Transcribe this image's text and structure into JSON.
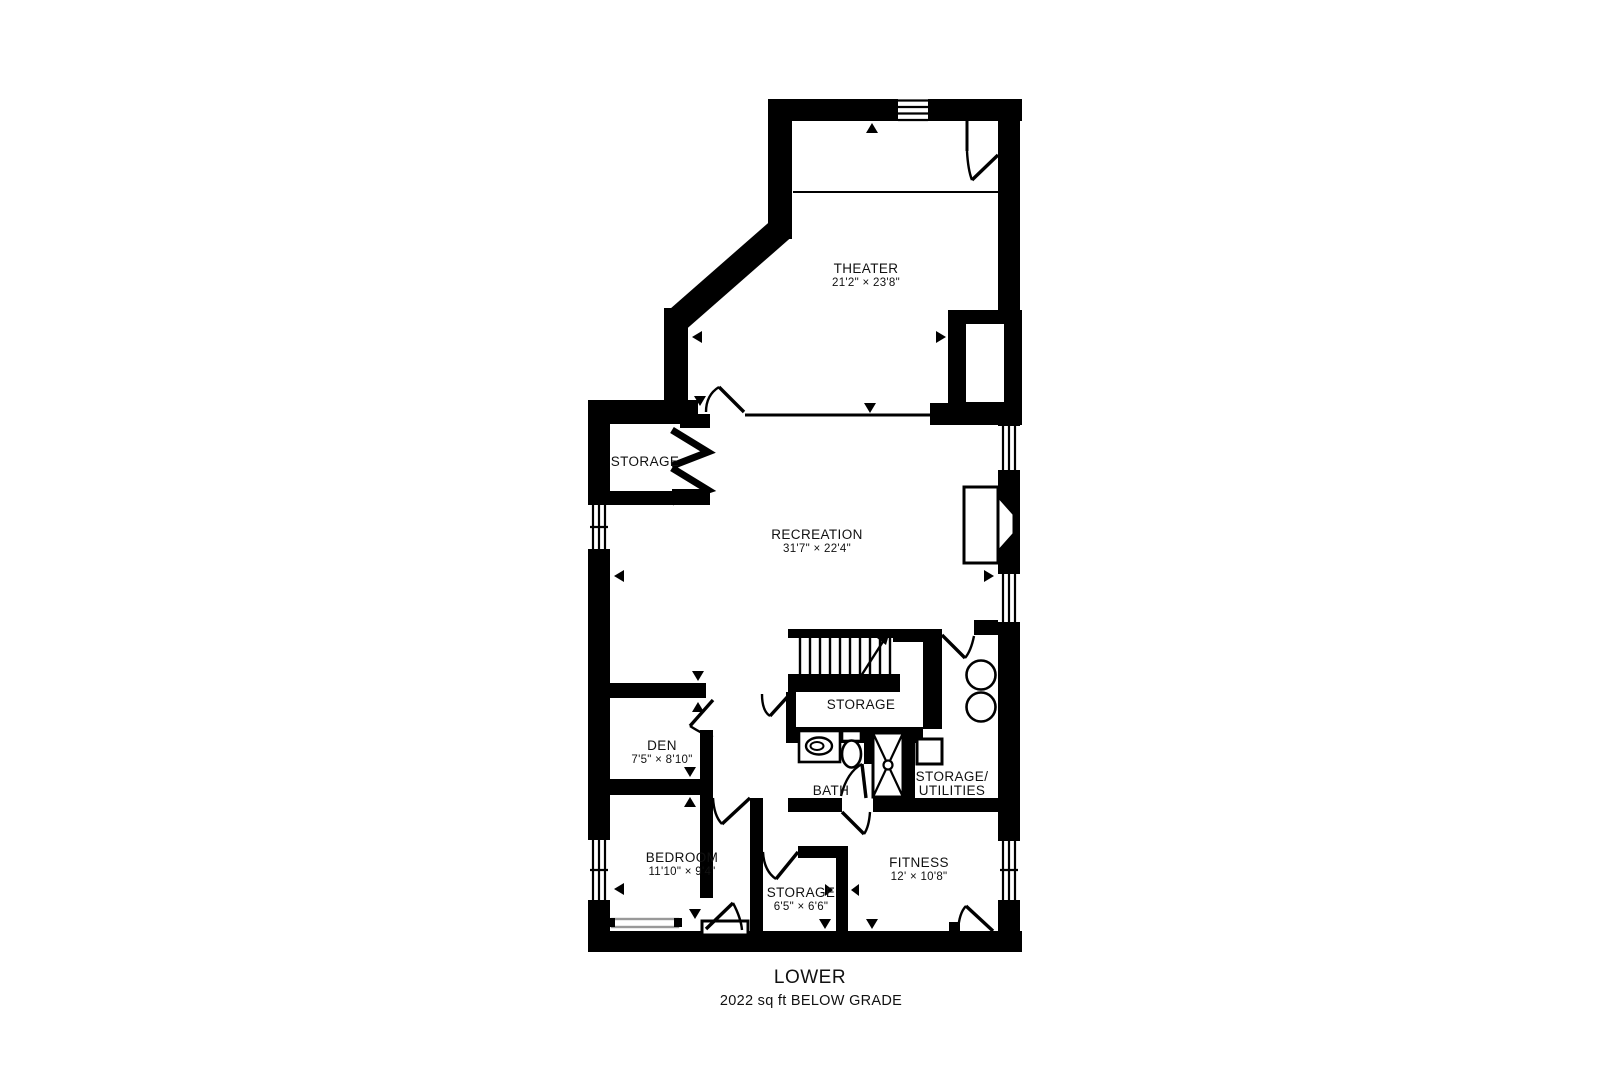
{
  "plan": {
    "title": "LOWER",
    "subtitle": "2022 sq ft BELOW GRADE",
    "colors": {
      "wall": "#000000",
      "background": "#ffffff",
      "shelf": "#999999"
    },
    "rooms": [
      {
        "id": "theater",
        "x": 866,
        "y": 276,
        "lines": [
          [
            "THEATER",
            "name"
          ],
          [
            "21'2\" × 23'8\"",
            "dims"
          ]
        ]
      },
      {
        "id": "storage-upper",
        "x": 645,
        "y": 462,
        "lines": [
          [
            "STORAGE",
            "name"
          ]
        ]
      },
      {
        "id": "recreation",
        "x": 817,
        "y": 542,
        "lines": [
          [
            "RECREATION",
            "name"
          ],
          [
            "31'7\" × 22'4\"",
            "dims"
          ]
        ]
      },
      {
        "id": "storage-stairs",
        "x": 861,
        "y": 705,
        "lines": [
          [
            "STORAGE",
            "name"
          ]
        ]
      },
      {
        "id": "den",
        "x": 662,
        "y": 753,
        "lines": [
          [
            "DEN",
            "name"
          ],
          [
            "7'5\" × 8'10\"",
            "dims"
          ]
        ]
      },
      {
        "id": "bath",
        "x": 831,
        "y": 791,
        "lines": [
          [
            "BATH",
            "name"
          ]
        ]
      },
      {
        "id": "storage-utilities",
        "x": 952,
        "y": 784,
        "lines": [
          [
            "STORAGE/",
            "name"
          ],
          [
            "UTILITIES",
            "name"
          ]
        ]
      },
      {
        "id": "bedroom",
        "x": 682,
        "y": 865,
        "lines": [
          [
            "BEDROOM",
            "name"
          ],
          [
            "11'10\" × 9'4\"",
            "dims"
          ]
        ]
      },
      {
        "id": "storage-lower",
        "x": 801,
        "y": 900,
        "lines": [
          [
            "STORAGE",
            "name"
          ],
          [
            "6'5\" × 6'6\"",
            "dims"
          ]
        ]
      },
      {
        "id": "fitness",
        "x": 919,
        "y": 870,
        "lines": [
          [
            "FITNESS",
            "name"
          ],
          [
            "12' × 10'8\"",
            "dims"
          ]
        ]
      }
    ]
  }
}
